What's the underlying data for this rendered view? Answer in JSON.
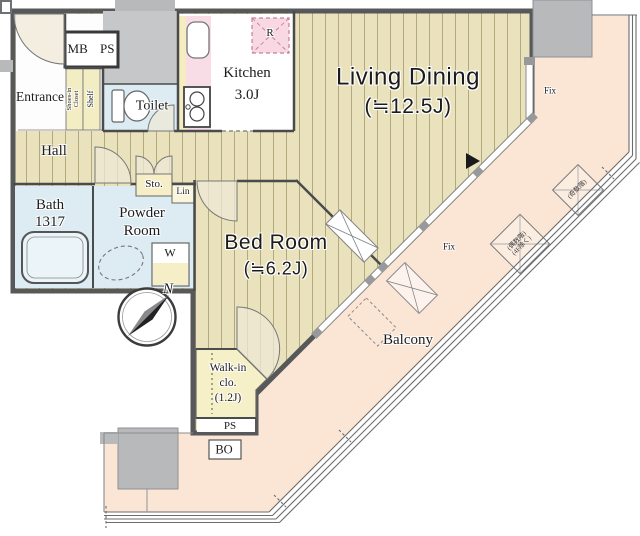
{
  "plan": {
    "rooms": {
      "entrance": {
        "label": "Entrance"
      },
      "mb_ps": {
        "label": "MB PS"
      },
      "shoes_closet": {
        "line1": "Shoes-in",
        "line2": "Closet"
      },
      "shelf": {
        "label": "Shelf"
      },
      "toilet": {
        "label": "Toilet"
      },
      "kitchen": {
        "label": "Kitchen",
        "size": "3.0J"
      },
      "refrigerator": {
        "label": "R"
      },
      "living_dining": {
        "label": "Living Dining",
        "size": "(≒12.5J)"
      },
      "hall": {
        "label": "Hall"
      },
      "bath": {
        "label": "Bath",
        "size": "1317"
      },
      "powder_room": {
        "line1": "Powder",
        "line2": "Room"
      },
      "storage": {
        "label": "Sto."
      },
      "linen": {
        "label": "Lin"
      },
      "washer": {
        "label": "W"
      },
      "bed_room": {
        "label": "Bed Room",
        "size": "(≒6.2J)"
      },
      "walk_in_closet": {
        "line1": "Walk-in",
        "line2": "clo.",
        "line3": "(1.2J)"
      },
      "pipe_space": {
        "label": "PS"
      },
      "bo": {
        "label": "BO"
      },
      "balcony": {
        "label": "Balcony"
      }
    },
    "annotations": {
      "fix_upper": "Fix",
      "fix_lower": "Fix",
      "compass_north": "N",
      "ac_unit_odd": "(奇数階)",
      "ac_unit_even_line1": "(偶数階)",
      "ac_unit_even_line2": "(4F除く)"
    },
    "colors": {
      "flooring": "#e9e2bc",
      "stripe": "#b3a97f",
      "balcony": "#fbe5d5",
      "wet_room": "#dcecf2",
      "closet_yellow": "#f5eec6",
      "counter_pink": "#f8dde7",
      "accent_yellow": "#f5edc0",
      "refrigerator_pink": "#f8d9e3",
      "wall": "#58595b",
      "pillar": "#b8b9bb"
    }
  }
}
